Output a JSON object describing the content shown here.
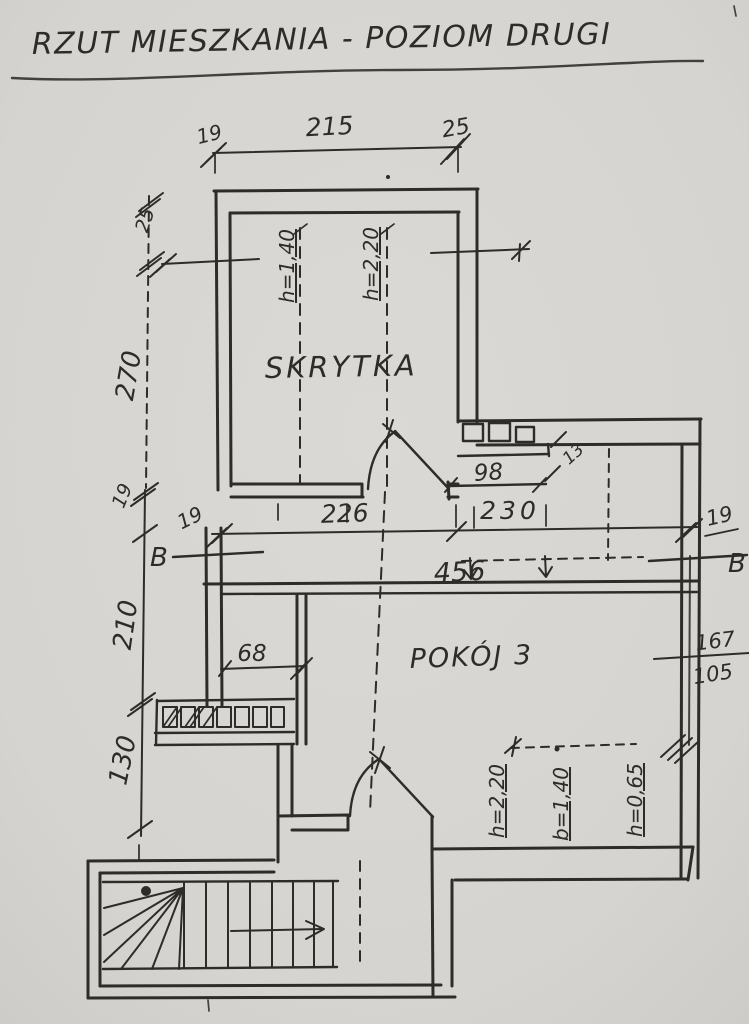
{
  "colors": {
    "paper": "#d7d5d1",
    "ink": "#2e2c29"
  },
  "labels": {
    "title": "RZUT MIESZKANIA - POZIOM DRUGI"
  },
  "rooms": {
    "skrytka": "SKRYTKA",
    "pokoj3": "POKÓJ 3"
  },
  "dims": {
    "top": {
      "wall_left": "19",
      "span": "215",
      "wall_right": "25"
    },
    "left": {
      "top_wall": "25",
      "upper": "270",
      "wall": "19",
      "middle": "210",
      "lower": "130"
    },
    "mid": {
      "wall_left": "19",
      "span_left": "226",
      "span_right": "230",
      "wall_right": "19",
      "total": "456"
    },
    "right": {
      "upper": "167",
      "lower": "105"
    },
    "niche": {
      "width": "98",
      "side": "13"
    },
    "alcove": "68"
  },
  "heights": {
    "skrytka_left": "h=1,40",
    "skrytka_right": "h=2,20",
    "bottom_left": "h=2,20",
    "bottom_mid": "b=1,40",
    "bottom_right": "h=0,65"
  },
  "section": {
    "left": "B",
    "right": "B"
  }
}
